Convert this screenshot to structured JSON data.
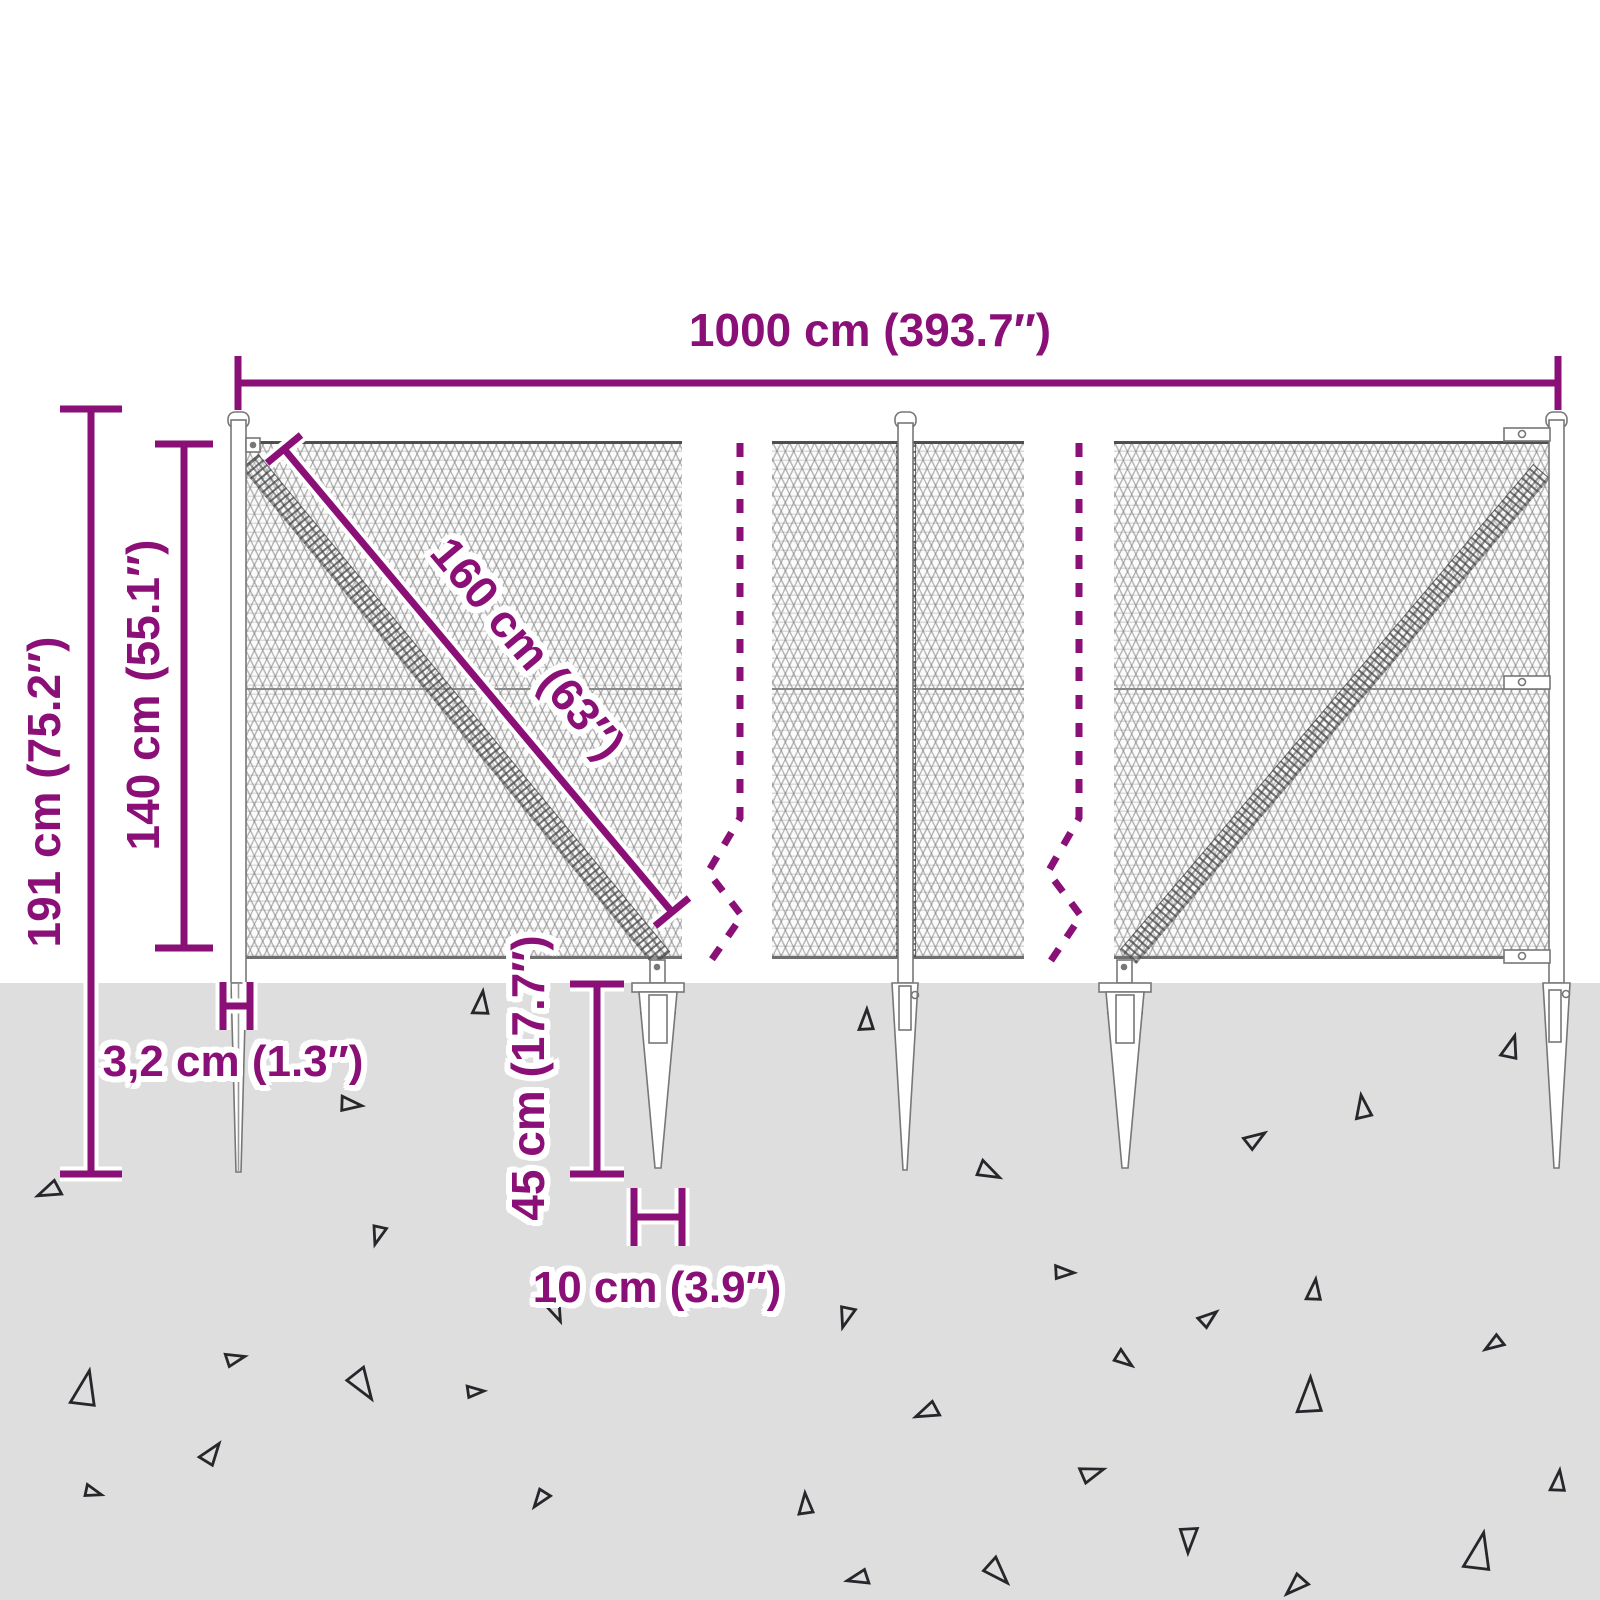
{
  "diagram": {
    "type": "product-dimension-diagram",
    "subject": "chain-link fence with ground spike anchors"
  },
  "labels": {
    "width_total": "1000 cm (393.7″)",
    "height_total": "191 cm (75.2″)",
    "height_mesh": "140 cm (55.1″)",
    "diagonal": "160 cm (63″)",
    "post_width": "3,2 cm (1.3″)",
    "spike_depth": "45 cm (17.7″)",
    "spike_spacing": "10 cm (3.9″)"
  },
  "colors": {
    "accent": "#8a0f76",
    "ground": "#dedede",
    "mesh_line": "#7a7a7a",
    "hardware_outline": "#777777",
    "debris": "#26262b"
  },
  "triangles": [
    {
      "x": 481,
      "y": 1002,
      "s": 22,
      "r": 10
    },
    {
      "x": 352,
      "y": 1104,
      "s": 20,
      "r": 100
    },
    {
      "x": 48,
      "y": 1192,
      "s": 22,
      "r": 250
    },
    {
      "x": 378,
      "y": 1236,
      "s": 18,
      "r": 200
    },
    {
      "x": 557,
      "y": 1312,
      "s": 20,
      "r": 160
    },
    {
      "x": 236,
      "y": 1358,
      "s": 18,
      "r": 80
    },
    {
      "x": 85,
      "y": 1387,
      "s": 34,
      "r": 15
    },
    {
      "x": 364,
      "y": 1386,
      "s": 30,
      "r": 150
    },
    {
      "x": 476,
      "y": 1391,
      "s": 16,
      "r": 90
    },
    {
      "x": 212,
      "y": 1452,
      "s": 22,
      "r": 40
    },
    {
      "x": 94,
      "y": 1492,
      "s": 16,
      "r": 110
    },
    {
      "x": 540,
      "y": 1500,
      "s": 18,
      "r": 220
    },
    {
      "x": 866,
      "y": 1019,
      "s": 20,
      "r": 5
    },
    {
      "x": 1511,
      "y": 1046,
      "s": 22,
      "r": 20
    },
    {
      "x": 1362,
      "y": 1106,
      "s": 22,
      "r": 355
    },
    {
      "x": 1256,
      "y": 1138,
      "s": 20,
      "r": 60
    },
    {
      "x": 990,
      "y": 1172,
      "s": 22,
      "r": 120
    },
    {
      "x": 1065,
      "y": 1272,
      "s": 18,
      "r": 95
    },
    {
      "x": 1314,
      "y": 1289,
      "s": 20,
      "r": 10
    },
    {
      "x": 846,
      "y": 1318,
      "s": 20,
      "r": 200
    },
    {
      "x": 1209,
      "y": 1317,
      "s": 18,
      "r": 55
    },
    {
      "x": 1493,
      "y": 1345,
      "s": 18,
      "r": 240
    },
    {
      "x": 1125,
      "y": 1360,
      "s": 18,
      "r": 130
    },
    {
      "x": 1309,
      "y": 1394,
      "s": 34,
      "r": 5
    },
    {
      "x": 926,
      "y": 1413,
      "s": 22,
      "r": 250
    },
    {
      "x": 1093,
      "y": 1472,
      "s": 22,
      "r": 75
    },
    {
      "x": 805,
      "y": 1503,
      "s": 20,
      "r": 0
    },
    {
      "x": 1558,
      "y": 1480,
      "s": 20,
      "r": 10
    },
    {
      "x": 1189,
      "y": 1541,
      "s": 24,
      "r": 185
    },
    {
      "x": 1479,
      "y": 1550,
      "s": 36,
      "r": 15
    },
    {
      "x": 857,
      "y": 1579,
      "s": 20,
      "r": 260
    },
    {
      "x": 999,
      "y": 1573,
      "s": 26,
      "r": 140
    },
    {
      "x": 1295,
      "y": 1587,
      "s": 22,
      "r": 230
    }
  ]
}
